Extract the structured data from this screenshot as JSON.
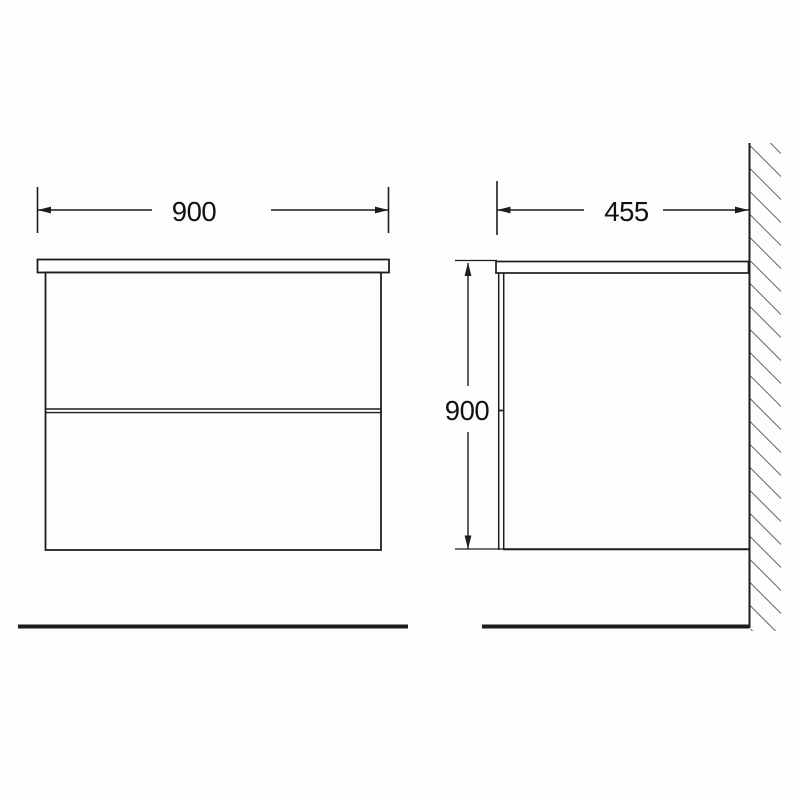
{
  "drawing": {
    "front_view": {
      "width_dimension": {
        "label": "900"
      }
    },
    "side_view": {
      "depth_dimension": {
        "label": "455"
      },
      "height_dimension": {
        "label": "900"
      }
    },
    "colors": {
      "line": "#1d1d1d",
      "text": "#111111",
      "background": "#fdfdfd"
    }
  }
}
